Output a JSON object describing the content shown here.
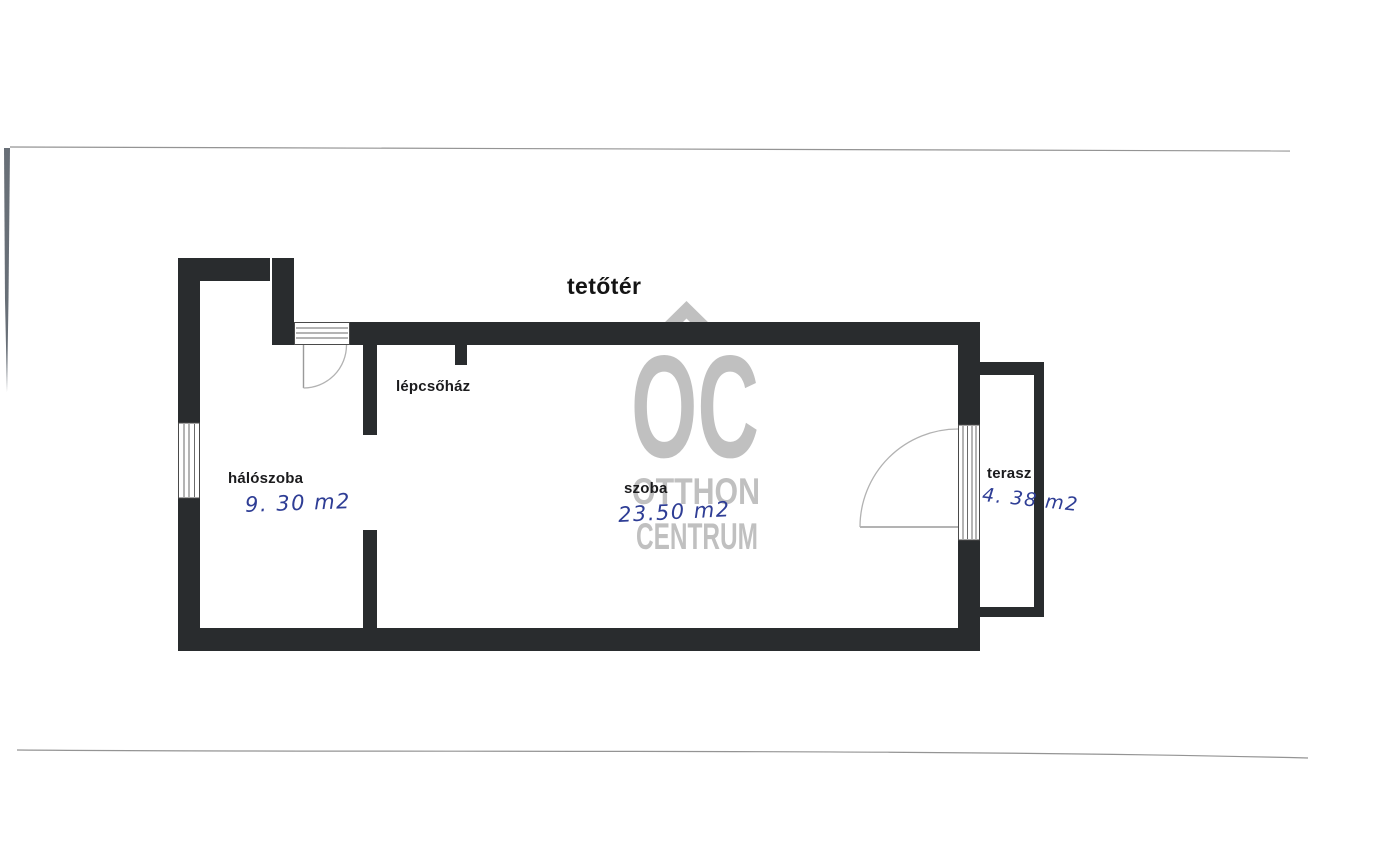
{
  "title": "tetőtér",
  "rooms": [
    {
      "name": "hálószoba",
      "area": "9. 30 m2"
    },
    {
      "name": "lépcsőház",
      "area": ""
    },
    {
      "name": "szoba",
      "area": "23.50 m2"
    },
    {
      "name": "terasz",
      "area": "4. 38 m2"
    }
  ],
  "watermark": {
    "logo": "OC",
    "line1": "OTTHON",
    "line2": "CENTRUM"
  },
  "colors": {
    "paper": "#ffffff",
    "wall": "#292c2e",
    "label": "#1b1b1d",
    "handwriting": "#2e3d95",
    "watermark": "#bdbdbd"
  }
}
